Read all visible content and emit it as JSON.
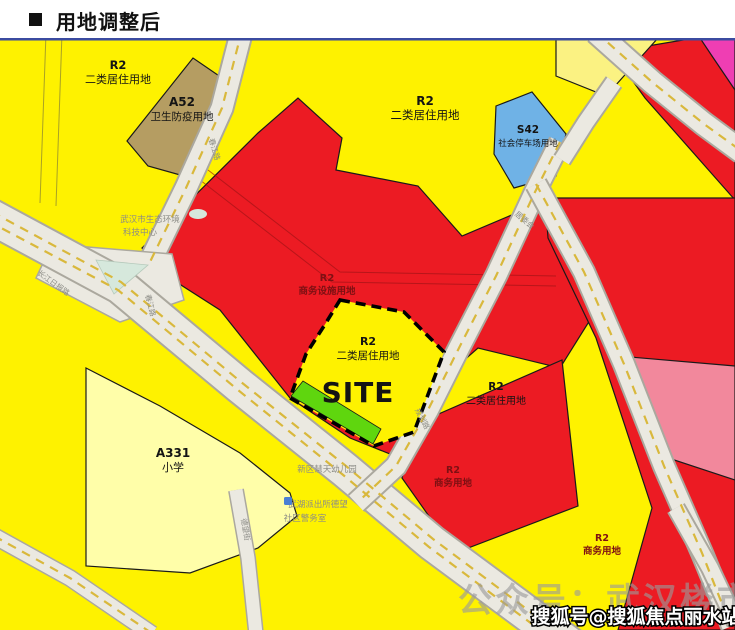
{
  "header": {
    "title": "用地调整后"
  },
  "colors": {
    "base_yellow": "#FEF200",
    "pale_yellow": "#FBF282",
    "cream_yellow": "#FFFEA9",
    "red": "#EC1B23",
    "magenta": "#EF3EB3",
    "pink": "#F2889C",
    "tan": "#B59D62",
    "blue": "#6FB2E6",
    "green": "#5FD60E",
    "mint": "#D6E8DC",
    "road_fill": "#EBE9E1",
    "road_edge": "#ABA89E",
    "road_dash": "#D9B83C",
    "ink": "#141414",
    "red_ink": "#7E1013",
    "gray_ink": "#8C8C86",
    "watermark_gray": "#9B9B9B",
    "map_border": "#3B4BA0"
  },
  "parcels": {
    "topleft_r2": {
      "code": "R2",
      "name": "二类居住用地"
    },
    "a52": {
      "code": "A52",
      "name": "卫生防疫用地"
    },
    "topcenter_r2": {
      "code": "R2",
      "name": "二类居住用地"
    },
    "s42": {
      "code": "S42",
      "name": "社会停车场用地"
    },
    "biz_facility": {
      "code": "R2",
      "name": "商务设施用地"
    },
    "site": {
      "code": "R2",
      "name": "二类居住用地",
      "mark": "SITE"
    },
    "east_r2": {
      "code": "R2",
      "name": "二类居住用地"
    },
    "south_biz": {
      "code": "R2",
      "name": "商务用地"
    },
    "southeast_biz": {
      "code": "R2",
      "name": "商务用地"
    },
    "a331": {
      "code": "A331",
      "name": "小学"
    }
  },
  "basemap": {
    "eco_center_line1": "武汉市生态环境",
    "eco_center_line2": "科技中心",
    "road_changjiang_ribao": "长江日报路",
    "road_chunjiang_north": "春江路",
    "road_chunjiang_south": "春江路",
    "road_east_of_site": "规划路",
    "road_dewang": "德望街",
    "kindergarten": "新区慧天幼儿园",
    "police_line1": "武湖派出所德望",
    "police_line2": "社区警务室",
    "committee": "居委会"
  },
  "watermarks": {
    "gray": "公众号：武汉楼市一线",
    "white": "搜狐号@搜狐焦点丽水站"
  }
}
